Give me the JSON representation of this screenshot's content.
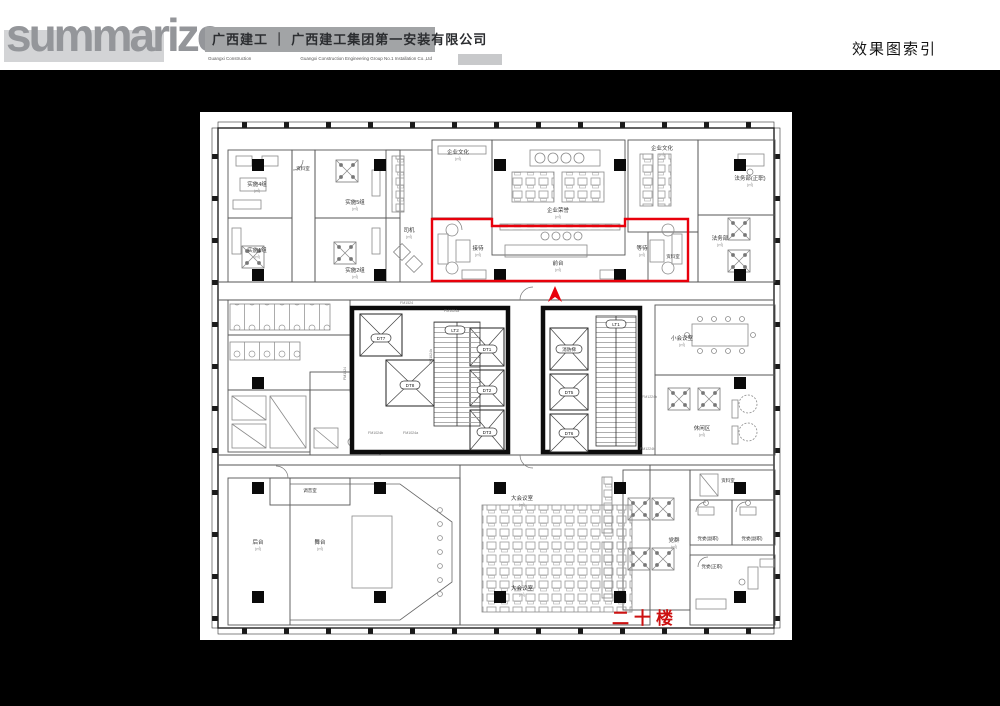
{
  "header": {
    "logo": "summarize",
    "company_cn": "广西建工 ｜ 广西建工集团第一安装有限公司",
    "company_en_1": "Guangxi Construction",
    "company_en_2": "Guangxi Construction Engineering Group No.1 Installation Co.,Ltd",
    "page_title": "效果图索引"
  },
  "floor_label": "二十楼",
  "plan": {
    "area_note": "(㎡)",
    "rooms": [
      {
        "label": "实施4组"
      },
      {
        "label": "实施5组"
      },
      {
        "label": "实施1组"
      },
      {
        "label": "实施2组"
      },
      {
        "label": "资料室"
      },
      {
        "label": "司机"
      },
      {
        "label": "企业文化"
      },
      {
        "label": "企业荣誉"
      },
      {
        "label": "企业文化"
      },
      {
        "label": "法务部(正职)"
      },
      {
        "label": "法务部"
      },
      {
        "label": "资料室"
      },
      {
        "label": "接待"
      },
      {
        "label": "前台"
      },
      {
        "label": "等待"
      },
      {
        "label": "小会议室"
      },
      {
        "label": "休闲区"
      },
      {
        "label": "调音室"
      },
      {
        "label": "后台"
      },
      {
        "label": "舞台"
      },
      {
        "label": "大会议室"
      },
      {
        "label": "大会议室"
      },
      {
        "label": "党群"
      },
      {
        "label": "资料室"
      },
      {
        "label": "党委(副职)"
      },
      {
        "label": "党委(副职)"
      },
      {
        "label": "党委(正职)"
      }
    ],
    "elevators": [
      "DT7",
      "DT8",
      "LT2",
      "DT1",
      "DT2",
      "DT3",
      "消防梯",
      "DT5",
      "DT6",
      "LT1"
    ],
    "door_tags": [
      "FM1524",
      "FM1024a",
      "FM1024b",
      "FM1024a",
      "FM1224b",
      "FM1224b",
      "FM1524",
      "FM1024b"
    ]
  }
}
